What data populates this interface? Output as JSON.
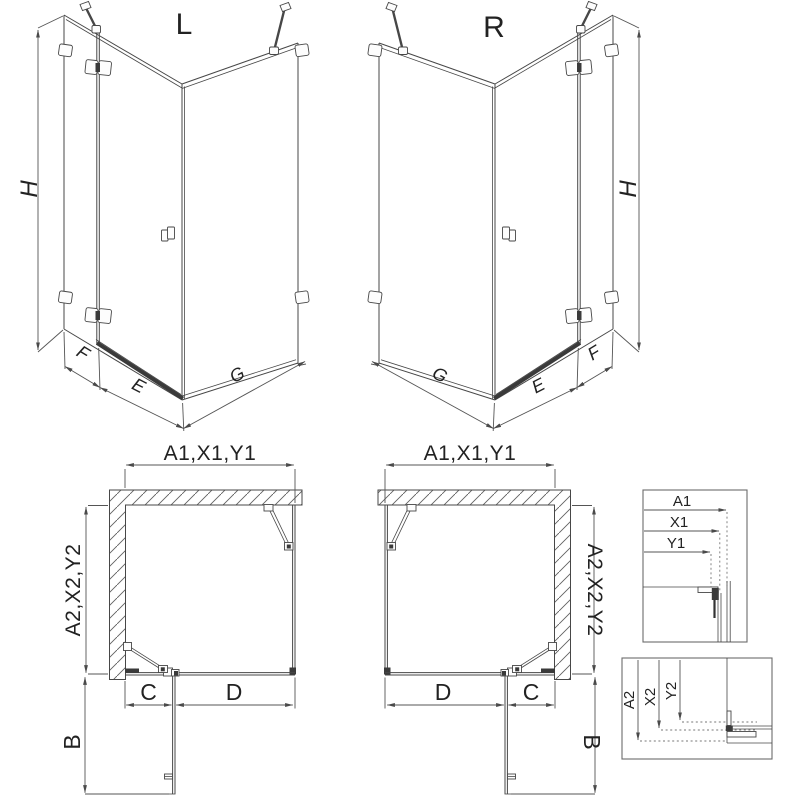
{
  "drawing": {
    "left_view_label": "L",
    "right_view_label": "R",
    "dims_3d": {
      "height": "H",
      "fixed_panel": "F",
      "door_width": "E",
      "side_panel": "G"
    },
    "dims_plan": {
      "width_group": "A1,X1,Y1",
      "depth_group": "A2,X2,Y2",
      "hinge_side": "C",
      "door_opening": "D",
      "door_projection": "B"
    },
    "detail_width_box": {
      "a1": "A1",
      "x1": "X1",
      "y1": "Y1"
    },
    "detail_depth_box": {
      "a2": "A2",
      "x2": "X2",
      "y2": "Y2"
    }
  },
  "colors": {
    "line": "#474747",
    "dim": "#555555",
    "dark": "#3a3a3a",
    "background": "#ffffff"
  }
}
